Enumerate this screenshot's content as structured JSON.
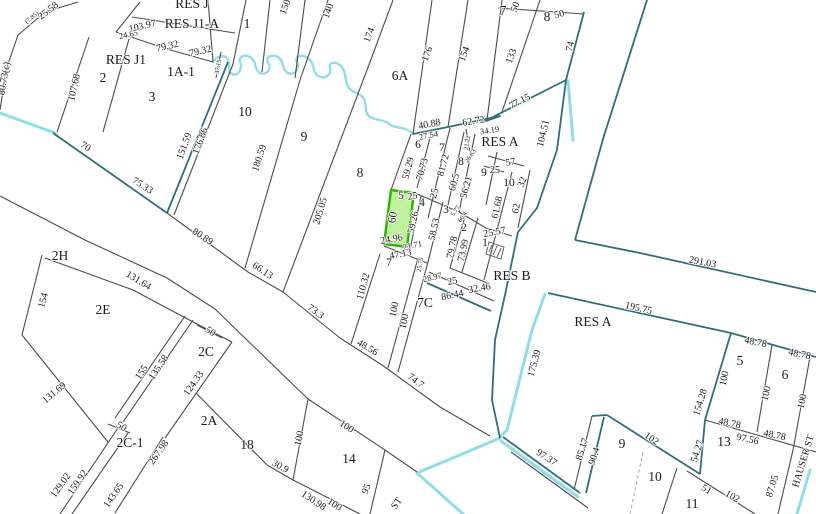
{
  "map": {
    "type": "cadastral-parcel-map",
    "colors": {
      "background": "#ffffff",
      "parcel_line": "#4c4c4c",
      "boundary_teal": "#2f6f7a",
      "water_cyan": "#85d9e3",
      "highlight_fill": "#8de849",
      "highlight_stroke": "#2eb400"
    },
    "highlighted_parcel": {
      "label": "5",
      "dim_top": "25",
      "dim_left": "60",
      "dim_bottom": "24.96"
    },
    "labels": [
      {
        "t": "RES J",
        "x": 192,
        "y": 8,
        "r": 0,
        "s": "lg"
      },
      {
        "t": "RES J1-A",
        "x": 192,
        "y": 28,
        "r": 0,
        "s": "lg"
      },
      {
        "t": "1",
        "x": 247,
        "y": 28,
        "r": 0,
        "s": "lg"
      },
      {
        "t": "103.97",
        "x": 143,
        "y": 29,
        "r": -13,
        "s": "sm"
      },
      {
        "t": "24.65",
        "x": 129,
        "y": 37,
        "r": -13,
        "s": "xs"
      },
      {
        "t": "79.32",
        "x": 168,
        "y": 49,
        "r": -13,
        "s": "sm"
      },
      {
        "t": "79.32",
        "x": 201,
        "y": 54,
        "r": -13,
        "s": "sm"
      },
      {
        "t": "25.58",
        "x": 50,
        "y": 13,
        "r": -38,
        "s": "sm"
      },
      {
        "t": "(7.85)",
        "x": 33,
        "y": 19,
        "r": -38,
        "s": "xxs"
      },
      {
        "t": "80.73(c)",
        "x": 7,
        "y": 79,
        "r": -80,
        "s": "sm"
      },
      {
        "t": "RES J1",
        "x": 126,
        "y": 64,
        "r": 0,
        "s": "lg"
      },
      {
        "t": "2",
        "x": 103,
        "y": 82,
        "r": 0,
        "s": "lg"
      },
      {
        "t": "1A-1",
        "x": 181,
        "y": 76,
        "r": 0,
        "s": "lg"
      },
      {
        "t": "107.68",
        "x": 77,
        "y": 88,
        "r": -78,
        "s": "sm"
      },
      {
        "t": "3",
        "x": 152,
        "y": 101,
        "r": 0,
        "s": "lg"
      },
      {
        "t": "37.15",
        "x": 220,
        "y": 67,
        "r": -80,
        "s": "xxs"
      },
      {
        "t": "70",
        "x": 84,
        "y": 149,
        "r": 33,
        "s": "sm"
      },
      {
        "t": "151.59",
        "x": 187,
        "y": 147,
        "r": -70,
        "s": "sm"
      },
      {
        "t": "176.86",
        "x": 203,
        "y": 142,
        "r": -70,
        "s": "sm"
      },
      {
        "t": "10",
        "x": 245,
        "y": 116,
        "r": 0,
        "s": "lg"
      },
      {
        "t": "180.59",
        "x": 262,
        "y": 159,
        "r": -72,
        "s": "sm"
      },
      {
        "t": "9",
        "x": 304,
        "y": 141,
        "r": 0,
        "s": "lg"
      },
      {
        "t": "205.05",
        "x": 323,
        "y": 212,
        "r": -73,
        "s": "sm"
      },
      {
        "t": "8",
        "x": 360,
        "y": 177,
        "r": 0,
        "s": "lg"
      },
      {
        "t": "75.33",
        "x": 141,
        "y": 188,
        "r": 33,
        "s": "sm"
      },
      {
        "t": "80.89",
        "x": 201,
        "y": 239,
        "r": 34,
        "s": "sm"
      },
      {
        "t": "66.13",
        "x": 261,
        "y": 273,
        "r": 34,
        "s": "sm"
      },
      {
        "t": "73.3",
        "x": 314,
        "y": 314,
        "r": 36,
        "s": "sm"
      },
      {
        "t": "48.56",
        "x": 366,
        "y": 350,
        "r": 31,
        "s": "sm"
      },
      {
        "t": "74.7",
        "x": 414,
        "y": 383,
        "r": 38,
        "s": "sm"
      },
      {
        "t": "2H",
        "x": 60,
        "y": 260,
        "r": 0,
        "s": "lg"
      },
      {
        "t": "154",
        "x": 46,
        "y": 301,
        "r": -75,
        "s": "sm"
      },
      {
        "t": "131.64",
        "x": 137,
        "y": 283,
        "r": 31,
        "s": "sm"
      },
      {
        "t": "2E",
        "x": 103,
        "y": 314,
        "r": 0,
        "s": "lg"
      },
      {
        "t": "131.69",
        "x": 56,
        "y": 395,
        "r": -40,
        "s": "sm"
      },
      {
        "t": "155",
        "x": 144,
        "y": 374,
        "r": -56,
        "s": "sm"
      },
      {
        "t": "135.58",
        "x": 161,
        "y": 369,
        "r": -56,
        "s": "sm"
      },
      {
        "t": "50",
        "x": 209,
        "y": 334,
        "r": 32,
        "s": "sm"
      },
      {
        "t": "2C",
        "x": 206,
        "y": 356,
        "r": 0,
        "s": "lg"
      },
      {
        "t": "124.33",
        "x": 196,
        "y": 385,
        "r": -55,
        "s": "sm"
      },
      {
        "t": "50",
        "x": 120,
        "y": 429,
        "r": 32,
        "s": "sm"
      },
      {
        "t": "2C-1",
        "x": 130,
        "y": 447,
        "r": 0,
        "s": "lg"
      },
      {
        "t": "129.02",
        "x": 63,
        "y": 487,
        "r": -55,
        "s": "sm"
      },
      {
        "t": "159.92",
        "x": 80,
        "y": 484,
        "r": -55,
        "s": "sm"
      },
      {
        "t": "267.98",
        "x": 161,
        "y": 454,
        "r": -55,
        "s": "sm"
      },
      {
        "t": "143.65",
        "x": 116,
        "y": 497,
        "r": -55,
        "s": "sm"
      },
      {
        "t": "2A",
        "x": 209,
        "y": 425,
        "r": 0,
        "s": "lg"
      },
      {
        "t": "18",
        "x": 247,
        "y": 449,
        "r": 0,
        "s": "lg"
      },
      {
        "t": "14",
        "x": 349,
        "y": 463,
        "r": 0,
        "s": "lg"
      },
      {
        "t": "100",
        "x": 345,
        "y": 429,
        "r": 33,
        "s": "sm"
      },
      {
        "t": "100",
        "x": 302,
        "y": 439,
        "r": -78,
        "s": "sm"
      },
      {
        "t": "30.9",
        "x": 279,
        "y": 469,
        "r": 28,
        "s": "sm"
      },
      {
        "t": "130.98",
        "x": 312,
        "y": 503,
        "r": 33,
        "s": "sm"
      },
      {
        "t": "100",
        "x": 333,
        "y": 507,
        "r": 33,
        "s": "sm"
      },
      {
        "t": "95",
        "x": 369,
        "y": 490,
        "r": -68,
        "s": "sm"
      },
      {
        "t": "ST",
        "x": 399,
        "y": 505,
        "r": -55,
        "s": "sm"
      },
      {
        "t": "150",
        "x": 288,
        "y": 8,
        "r": -70,
        "s": "sm"
      },
      {
        "t": "140",
        "x": 331,
        "y": 12,
        "r": -70,
        "s": "sm"
      },
      {
        "t": "174",
        "x": 372,
        "y": 36,
        "r": -70,
        "s": "sm"
      },
      {
        "t": "6A",
        "x": 400,
        "y": 80,
        "r": 0,
        "s": "lg"
      },
      {
        "t": "176",
        "x": 430,
        "y": 55,
        "r": -70,
        "s": "sm"
      },
      {
        "t": "154",
        "x": 467,
        "y": 55,
        "r": -70,
        "s": "sm"
      },
      {
        "t": "133",
        "x": 514,
        "y": 57,
        "r": -70,
        "s": "sm"
      },
      {
        "t": "7",
        "x": 503,
        "y": 15,
        "r": 0,
        "s": "lg"
      },
      {
        "t": "50",
        "x": 518,
        "y": 8,
        "r": -70,
        "s": "sm"
      },
      {
        "t": "8",
        "x": 547,
        "y": 21,
        "r": 0,
        "s": "lg"
      },
      {
        "t": "50",
        "x": 560,
        "y": 17,
        "r": -15,
        "s": "sm"
      },
      {
        "t": "74",
        "x": 573,
        "y": 47,
        "r": -78,
        "s": "sm"
      },
      {
        "t": "77.15",
        "x": 521,
        "y": 104,
        "r": -27,
        "s": "sm"
      },
      {
        "t": "104.51",
        "x": 546,
        "y": 134,
        "r": -77,
        "s": "sm"
      },
      {
        "t": "40.88",
        "x": 430,
        "y": 127,
        "r": -11,
        "s": "sm"
      },
      {
        "t": "27.54",
        "x": 429,
        "y": 138,
        "r": -11,
        "s": "xs"
      },
      {
        "t": "62.72",
        "x": 474,
        "y": 124,
        "r": -9,
        "s": "sm"
      },
      {
        "t": "34.19",
        "x": 490,
        "y": 133,
        "r": -9,
        "s": "xs"
      },
      {
        "t": "21.22",
        "x": 469,
        "y": 143,
        "r": -80,
        "s": "xxs"
      },
      {
        "t": "RES A",
        "x": 500,
        "y": 146,
        "r": 0,
        "s": "lg"
      },
      {
        "t": "6",
        "x": 418,
        "y": 148,
        "r": 0,
        "s": "md"
      },
      {
        "t": "59.29",
        "x": 411,
        "y": 169,
        "r": -75,
        "s": "sm"
      },
      {
        "t": "70.73",
        "x": 425,
        "y": 170,
        "r": -75,
        "s": "sm"
      },
      {
        "t": "7",
        "x": 442,
        "y": 151,
        "r": 0,
        "s": "md"
      },
      {
        "t": "81.72",
        "x": 446,
        "y": 166,
        "r": -75,
        "s": "sm"
      },
      {
        "t": "25",
        "x": 437,
        "y": 194,
        "r": -75,
        "s": "sm"
      },
      {
        "t": "8",
        "x": 461,
        "y": 165,
        "r": 0,
        "s": "md"
      },
      {
        "t": "26.63",
        "x": 472,
        "y": 157,
        "r": -55,
        "s": "xxs"
      },
      {
        "t": "60.5",
        "x": 457,
        "y": 183,
        "r": -75,
        "s": "sm"
      },
      {
        "t": "56.21",
        "x": 469,
        "y": 188,
        "r": -75,
        "s": "sm"
      },
      {
        "t": "9",
        "x": 484,
        "y": 176,
        "r": 0,
        "s": "md"
      },
      {
        "t": "25",
        "x": 495,
        "y": 173,
        "r": 0,
        "s": "sm"
      },
      {
        "t": "57",
        "x": 511,
        "y": 165,
        "r": -10,
        "s": "sm"
      },
      {
        "t": "10",
        "x": 509,
        "y": 186,
        "r": 0,
        "s": "md"
      },
      {
        "t": "32",
        "x": 525,
        "y": 183,
        "r": -70,
        "s": "sm"
      },
      {
        "t": "61.68",
        "x": 500,
        "y": 208,
        "r": -78,
        "s": "sm"
      },
      {
        "t": "62",
        "x": 519,
        "y": 209,
        "r": -78,
        "s": "sm"
      },
      {
        "t": "5",
        "x": 401,
        "y": 199,
        "r": 0,
        "s": "md"
      },
      {
        "t": "25",
        "x": 413,
        "y": 199,
        "r": -10,
        "s": "sm"
      },
      {
        "t": "60",
        "x": 396,
        "y": 218,
        "r": -80,
        "s": "md"
      },
      {
        "t": "24.96",
        "x": 392,
        "y": 242,
        "r": -10,
        "s": "sm"
      },
      {
        "t": "4",
        "x": 422,
        "y": 206,
        "r": 0,
        "s": "md"
      },
      {
        "t": "59.26",
        "x": 416,
        "y": 223,
        "r": -77,
        "s": "sm"
      },
      {
        "t": "3",
        "x": 446,
        "y": 213,
        "r": 0,
        "s": "md"
      },
      {
        "t": "5.77",
        "x": 457,
        "y": 212,
        "r": -55,
        "s": "xxs"
      },
      {
        "t": "66.4",
        "x": 464,
        "y": 218,
        "r": -55,
        "s": "xxs"
      },
      {
        "t": "58.53",
        "x": 437,
        "y": 230,
        "r": -77,
        "s": "sm"
      },
      {
        "t": "2",
        "x": 464,
        "y": 231,
        "r": 0,
        "s": "md"
      },
      {
        "t": "79.78",
        "x": 455,
        "y": 248,
        "r": -78,
        "s": "sm"
      },
      {
        "t": "73.99",
        "x": 466,
        "y": 251,
        "r": -78,
        "s": "sm"
      },
      {
        "t": "1",
        "x": 485,
        "y": 246,
        "r": 0,
        "s": "md"
      },
      {
        "t": "25.57",
        "x": 495,
        "y": 235,
        "r": -10,
        "s": "sm"
      },
      {
        "t": "21.71",
        "x": 413,
        "y": 248,
        "r": -12,
        "s": "xs"
      },
      {
        "t": "47.13",
        "x": 401,
        "y": 257,
        "r": -11,
        "s": "sm"
      },
      {
        "t": "7",
        "x": 389,
        "y": 266,
        "r": 0,
        "s": "md"
      },
      {
        "t": "25.75",
        "x": 422,
        "y": 265,
        "r": -80,
        "s": "xxs"
      },
      {
        "t": "28.97",
        "x": 433,
        "y": 280,
        "r": -14,
        "s": "xs"
      },
      {
        "t": "25",
        "x": 453,
        "y": 284,
        "r": -12,
        "s": "sm"
      },
      {
        "t": "32.46",
        "x": 480,
        "y": 291,
        "r": -10,
        "s": "sm"
      },
      {
        "t": "86.44",
        "x": 453,
        "y": 298,
        "r": -12,
        "s": "sm"
      },
      {
        "t": "110.32",
        "x": 366,
        "y": 287,
        "r": -75,
        "s": "sm"
      },
      {
        "t": "100",
        "x": 397,
        "y": 310,
        "r": -78,
        "s": "sm"
      },
      {
        "t": "100",
        "x": 407,
        "y": 322,
        "r": -78,
        "s": "sm"
      },
      {
        "t": "7C",
        "x": 425,
        "y": 307,
        "r": 0,
        "s": "lg"
      },
      {
        "t": "RES B",
        "x": 512,
        "y": 280,
        "r": 0,
        "s": "lg"
      },
      {
        "t": "291.03",
        "x": 702,
        "y": 265,
        "r": 11,
        "s": "sm"
      },
      {
        "t": "195.75",
        "x": 638,
        "y": 311,
        "r": 12,
        "s": "sm"
      },
      {
        "t": "RES A",
        "x": 593,
        "y": 326,
        "r": 0,
        "s": "lg"
      },
      {
        "t": "175.39",
        "x": 537,
        "y": 364,
        "r": -74,
        "s": "sm"
      },
      {
        "t": "97.37",
        "x": 545,
        "y": 460,
        "r": 33,
        "s": "sm"
      },
      {
        "t": "85.17",
        "x": 585,
        "y": 450,
        "r": -72,
        "s": "sm"
      },
      {
        "t": "90.4",
        "x": 597,
        "y": 457,
        "r": -72,
        "s": "sm"
      },
      {
        "t": "9",
        "x": 622,
        "y": 448,
        "r": 0,
        "s": "lg"
      },
      {
        "t": "102",
        "x": 650,
        "y": 441,
        "r": 34,
        "s": "sm"
      },
      {
        "t": "10",
        "x": 655,
        "y": 481,
        "r": 0,
        "s": "lg"
      },
      {
        "t": "54.27",
        "x": 700,
        "y": 452,
        "r": -72,
        "s": "sm"
      },
      {
        "t": "13",
        "x": 724,
        "y": 446,
        "r": 0,
        "s": "lg"
      },
      {
        "t": "97.56",
        "x": 747,
        "y": 442,
        "r": 12,
        "s": "sm"
      },
      {
        "t": "48.78",
        "x": 729,
        "y": 426,
        "r": 12,
        "s": "sm"
      },
      {
        "t": "48.78",
        "x": 774,
        "y": 438,
        "r": 12,
        "s": "sm"
      },
      {
        "t": "48.78",
        "x": 755,
        "y": 345,
        "r": 12,
        "s": "sm"
      },
      {
        "t": "48.78",
        "x": 799,
        "y": 357,
        "r": 12,
        "s": "sm"
      },
      {
        "t": "5",
        "x": 740,
        "y": 365,
        "r": 0,
        "s": "lg"
      },
      {
        "t": "6",
        "x": 785,
        "y": 379,
        "r": 0,
        "s": "lg"
      },
      {
        "t": "100",
        "x": 727,
        "y": 379,
        "r": -77,
        "s": "sm"
      },
      {
        "t": "100",
        "x": 769,
        "y": 394,
        "r": -77,
        "s": "sm"
      },
      {
        "t": "100",
        "x": 805,
        "y": 402,
        "r": -77,
        "s": "sm"
      },
      {
        "t": "154.28",
        "x": 703,
        "y": 403,
        "r": -73,
        "s": "sm"
      },
      {
        "t": "51",
        "x": 705,
        "y": 492,
        "r": 30,
        "s": "sm"
      },
      {
        "t": "102",
        "x": 731,
        "y": 499,
        "r": 30,
        "s": "sm"
      },
      {
        "t": "11",
        "x": 692,
        "y": 508,
        "r": 0,
        "s": "lg"
      },
      {
        "t": "87.05",
        "x": 775,
        "y": 487,
        "r": -73,
        "s": "sm"
      },
      {
        "t": "HAUSER ST",
        "x": 806,
        "y": 462,
        "r": -73,
        "s": "sm"
      }
    ]
  }
}
